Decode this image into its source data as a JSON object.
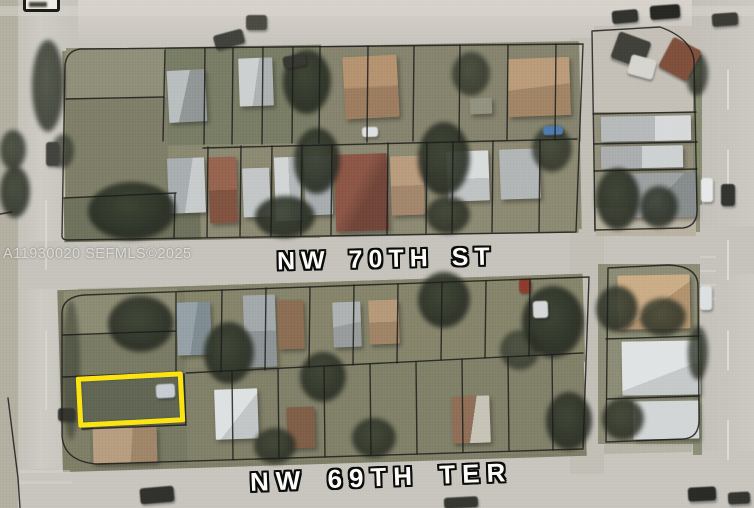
{
  "map": {
    "type": "aerial-parcel-map",
    "streets": {
      "horizontal_mid": "NW 70TH ST",
      "horizontal_bottom": "NW 69TH TER"
    },
    "watermark": "A11930020 SEFMLS©2025",
    "colors": {
      "highlight": "#FFE50A",
      "parcel_line": "#141414",
      "road": "#C9C6C0",
      "label_text": "#FFFFFF",
      "label_outline": "#000000"
    },
    "features": {
      "patches": [
        {
          "x": 0,
          "y": 0,
          "w": 18,
          "h": 508,
          "c": "#b3afa2"
        },
        {
          "x": 64,
          "y": 46,
          "w": 516,
          "h": 188,
          "c": "#87866f",
          "r": -1.1
        },
        {
          "x": 66,
          "y": 48,
          "w": 100,
          "h": 52,
          "c": "#8e8d76"
        },
        {
          "x": 66,
          "y": 98,
          "w": 102,
          "h": 100,
          "c": "#7c7c66"
        },
        {
          "x": 166,
          "y": 46,
          "w": 156,
          "h": 98,
          "c": "#757a62",
          "r": -1
        },
        {
          "x": 320,
          "y": 44,
          "w": 260,
          "h": 100,
          "c": "#83816b",
          "r": -1
        },
        {
          "x": 64,
          "y": 196,
          "w": 256,
          "h": 44,
          "c": "#6b6e58",
          "r": -1
        },
        {
          "x": 200,
          "y": 146,
          "w": 378,
          "h": 90,
          "c": "#8a8770",
          "r": -1
        },
        {
          "x": 594,
          "y": 26,
          "w": 104,
          "h": 88,
          "c": "#c4c0b8"
        },
        {
          "x": 594,
          "y": 112,
          "w": 106,
          "h": 120,
          "c": "#8f8d78"
        },
        {
          "x": 596,
          "y": 208,
          "w": 100,
          "h": 28,
          "c": "#b9b2a2"
        },
        {
          "x": 60,
          "y": 282,
          "w": 524,
          "h": 182,
          "c": "#7c7b64",
          "r": -1.8
        },
        {
          "x": 64,
          "y": 290,
          "w": 114,
          "h": 44,
          "c": "#8a8971",
          "r": -1.5
        },
        {
          "x": 64,
          "y": 334,
          "w": 120,
          "h": 44,
          "c": "#777861",
          "r": -1.5
        },
        {
          "x": 80,
          "y": 376,
          "w": 108,
          "h": 52,
          "c": "#5c6350",
          "r": -3
        },
        {
          "x": 90,
          "y": 428,
          "w": 100,
          "h": 38,
          "c": "#74755f",
          "r": -1.5
        },
        {
          "x": 186,
          "y": 280,
          "w": 398,
          "h": 88,
          "c": "#838269",
          "r": -1.8
        },
        {
          "x": 186,
          "y": 362,
          "w": 398,
          "h": 96,
          "c": "#7e7d66",
          "r": -1.8
        },
        {
          "x": 598,
          "y": 264,
          "w": 102,
          "h": 180,
          "c": "#8b8a73"
        },
        {
          "x": 693,
          "y": 55,
          "w": 9,
          "h": 150,
          "c": "#7f8468",
          "o": 0.9
        },
        {
          "x": 693,
          "y": 335,
          "w": 9,
          "h": 120,
          "c": "#7f8468",
          "o": 0.85
        },
        {
          "x": 0,
          "y": 6,
          "w": 754,
          "h": 10,
          "c": "#dcd7d1",
          "o": 0.5
        },
        {
          "x": 45,
          "y": 60,
          "w": 2,
          "h": 60,
          "c": "#e8e5df",
          "o": 0.4
        },
        {
          "x": 45,
          "y": 200,
          "w": 2,
          "h": 70,
          "c": "#e8e5df",
          "o": 0.5
        },
        {
          "x": 45,
          "y": 330,
          "w": 2,
          "h": 80,
          "c": "#e8e5df",
          "o": 0.45
        },
        {
          "x": 727,
          "y": 70,
          "w": 2,
          "h": 40,
          "c": "#eeece6",
          "o": 0.6
        },
        {
          "x": 727,
          "y": 150,
          "w": 2,
          "h": 40,
          "c": "#eeece6",
          "o": 0.6
        },
        {
          "x": 727,
          "y": 240,
          "w": 2,
          "h": 40,
          "c": "#eeece6",
          "o": 0.6
        },
        {
          "x": 727,
          "y": 330,
          "w": 2,
          "h": 40,
          "c": "#eeece6",
          "o": 0.6
        },
        {
          "x": 727,
          "y": 420,
          "w": 2,
          "h": 40,
          "c": "#eeece6",
          "o": 0.6
        },
        {
          "x": 700,
          "y": 256,
          "w": 16,
          "h": 2,
          "c": "#dddbd5",
          "o": 0.5
        },
        {
          "x": 700,
          "y": 270,
          "w": 16,
          "h": 2,
          "c": "#dddbd5",
          "o": 0.5
        },
        {
          "x": 700,
          "y": 284,
          "w": 16,
          "h": 2,
          "c": "#dddbd5",
          "o": 0.5
        },
        {
          "x": 700,
          "y": 298,
          "w": 16,
          "h": 2,
          "c": "#dddbd5",
          "o": 0.5
        },
        {
          "x": 20,
          "y": 470,
          "w": 50,
          "h": 3,
          "c": "#d8d5cf",
          "o": 0.5
        },
        {
          "x": 20,
          "y": 481,
          "w": 52,
          "h": 3,
          "c": "#d8d5cf",
          "o": 0.45
        }
      ],
      "houses": [
        {
          "x": 168,
          "y": 70,
          "w": 38,
          "h": 52,
          "c": "linear-gradient(105deg,#b9bec0 45%,#8f9496 45%)",
          "r": -3
        },
        {
          "x": 239,
          "y": 58,
          "w": 34,
          "h": 48,
          "c": "linear-gradient(100deg,#cdd1d3 50%,#aeb2b4 50%)",
          "r": -2
        },
        {
          "x": 344,
          "y": 56,
          "w": 54,
          "h": 62,
          "c": "linear-gradient(180deg,#b5916e 48%,#9a7a5c 52%)",
          "r": -3
        },
        {
          "x": 508,
          "y": 58,
          "w": 62,
          "h": 58,
          "c": "linear-gradient(175deg,#bb9a78 50%,#a08263 50%)",
          "r": -2
        },
        {
          "x": 470,
          "y": 98,
          "w": 22,
          "h": 16,
          "c": "#90907f",
          "r": -2
        },
        {
          "x": 168,
          "y": 158,
          "w": 37,
          "h": 55,
          "c": "linear-gradient(100deg,#a8aeb0 55%,#c8cccd 55%)",
          "r": -2
        },
        {
          "x": 209,
          "y": 157,
          "w": 28,
          "h": 66,
          "c": "linear-gradient(180deg,#95604a 50%,#7e4e3c 50%)",
          "r": -2
        },
        {
          "x": 243,
          "y": 168,
          "w": 27,
          "h": 49,
          "c": "#c3c7c9",
          "r": -2
        },
        {
          "x": 275,
          "y": 157,
          "w": 26,
          "h": 64,
          "c": "linear-gradient(90deg,#d2d6d8 55%,#b4b8ba 55%)",
          "r": -2
        },
        {
          "x": 305,
          "y": 156,
          "w": 27,
          "h": 59,
          "c": "#a6acae",
          "r": -2
        },
        {
          "x": 335,
          "y": 154,
          "w": 53,
          "h": 77,
          "c": "linear-gradient(120deg,#8a5242 40%,#6e4034 60%)",
          "r": -2
        },
        {
          "x": 391,
          "y": 156,
          "w": 33,
          "h": 59,
          "c": "linear-gradient(180deg,#b99a7c 50%,#a2846a 50%)",
          "r": -2
        },
        {
          "x": 447,
          "y": 151,
          "w": 42,
          "h": 50,
          "c": "linear-gradient(180deg,#dadee0 55%,#bfc3c5 45%)",
          "r": -2
        },
        {
          "x": 500,
          "y": 149,
          "w": 40,
          "h": 50,
          "c": "#b2b6b8",
          "r": -2
        },
        {
          "x": 601,
          "y": 116,
          "w": 90,
          "h": 25,
          "c": "linear-gradient(90deg,#b6babc 60%,#d8dbdd 60%)",
          "r": -1
        },
        {
          "x": 601,
          "y": 146,
          "w": 82,
          "h": 22,
          "c": "linear-gradient(90deg,#a9adaf 50%,#cfd2d4 50%)",
          "r": -1
        },
        {
          "x": 630,
          "y": 173,
          "w": 66,
          "h": 44,
          "c": "linear-gradient(135deg,#9a9fa1 50%,#84898b 50%)",
          "r": -1
        },
        {
          "x": 177,
          "y": 302,
          "w": 34,
          "h": 53,
          "c": "linear-gradient(100deg,#93a0a6 50%,#7c8a90 50%)",
          "r": -2
        },
        {
          "x": 244,
          "y": 295,
          "w": 32,
          "h": 72,
          "c": "linear-gradient(180deg,#a2a8aa 50%,#8c9294 50%)",
          "r": -2
        },
        {
          "x": 278,
          "y": 300,
          "w": 26,
          "h": 49,
          "c": "#8a6a50",
          "r": -2
        },
        {
          "x": 333,
          "y": 302,
          "w": 28,
          "h": 45,
          "c": "linear-gradient(170deg,#aeb2b4 50%,#969a9c 50%)",
          "r": -2
        },
        {
          "x": 369,
          "y": 300,
          "w": 30,
          "h": 44,
          "c": "linear-gradient(180deg,#b59878 50%,#9e8162 50%)",
          "r": -2
        },
        {
          "x": 93,
          "y": 427,
          "w": 64,
          "h": 36,
          "c": "linear-gradient(95deg,#b89c7e 60%,#9f8366 40%)",
          "r": -1.5
        },
        {
          "x": 215,
          "y": 389,
          "w": 43,
          "h": 50,
          "c": "linear-gradient(130deg,#e0e3e5 55%,#c3c7c9 45%)",
          "r": -2
        },
        {
          "x": 287,
          "y": 407,
          "w": 28,
          "h": 41,
          "c": "#7d5a44",
          "r": -2
        },
        {
          "x": 452,
          "y": 396,
          "w": 38,
          "h": 47,
          "c": "linear-gradient(100deg,#8d6b54 55%,#c9c3b8 45%)",
          "r": -2
        },
        {
          "x": 618,
          "y": 275,
          "w": 72,
          "h": 54,
          "c": "linear-gradient(145deg,#cbac85 55%,#b2916c 45%)",
          "r": -1
        },
        {
          "x": 622,
          "y": 341,
          "w": 78,
          "h": 54,
          "c": "linear-gradient(160deg,#e2e5e7 60%,#c6cacc 40%)",
          "r": -1
        },
        {
          "x": 633,
          "y": 401,
          "w": 66,
          "h": 38,
          "c": "#d4d7d9",
          "r": -1
        }
      ],
      "trees": [
        {
          "x": 32,
          "y": 40,
          "w": 32,
          "h": 92,
          "o": 0.8
        },
        {
          "x": 0,
          "y": 130,
          "w": 26,
          "h": 40,
          "o": 0.8
        },
        {
          "x": 0,
          "y": 166,
          "w": 30,
          "h": 52,
          "o": 0.85
        },
        {
          "x": 52,
          "y": 134,
          "w": 22,
          "h": 34,
          "o": 0.7
        },
        {
          "x": 283,
          "y": 50,
          "w": 48,
          "h": 64,
          "o": 0.9
        },
        {
          "x": 294,
          "y": 128,
          "w": 46,
          "h": 66,
          "o": 0.9
        },
        {
          "x": 255,
          "y": 196,
          "w": 60,
          "h": 42,
          "o": 0.9
        },
        {
          "x": 88,
          "y": 182,
          "w": 88,
          "h": 58,
          "o": 0.92
        },
        {
          "x": 418,
          "y": 122,
          "w": 52,
          "h": 74,
          "o": 0.9
        },
        {
          "x": 452,
          "y": 52,
          "w": 38,
          "h": 44,
          "o": 0.75
        },
        {
          "x": 532,
          "y": 126,
          "w": 40,
          "h": 46,
          "o": 0.8
        },
        {
          "x": 426,
          "y": 196,
          "w": 44,
          "h": 38,
          "o": 0.85
        },
        {
          "x": 596,
          "y": 168,
          "w": 44,
          "h": 62,
          "o": 0.9
        },
        {
          "x": 640,
          "y": 186,
          "w": 38,
          "h": 42,
          "o": 0.85
        },
        {
          "x": 686,
          "y": 52,
          "w": 22,
          "h": 44,
          "o": 0.8
        },
        {
          "x": 688,
          "y": 326,
          "w": 20,
          "h": 54,
          "o": 0.8
        },
        {
          "x": 108,
          "y": 296,
          "w": 66,
          "h": 56,
          "o": 0.9
        },
        {
          "x": 204,
          "y": 322,
          "w": 50,
          "h": 62,
          "o": 0.9
        },
        {
          "x": 300,
          "y": 352,
          "w": 46,
          "h": 50,
          "o": 0.88
        },
        {
          "x": 418,
          "y": 272,
          "w": 52,
          "h": 56,
          "o": 0.9
        },
        {
          "x": 522,
          "y": 286,
          "w": 62,
          "h": 72,
          "o": 0.92
        },
        {
          "x": 546,
          "y": 392,
          "w": 46,
          "h": 58,
          "o": 0.9
        },
        {
          "x": 254,
          "y": 428,
          "w": 42,
          "h": 36,
          "o": 0.85
        },
        {
          "x": 352,
          "y": 418,
          "w": 44,
          "h": 40,
          "o": 0.85
        },
        {
          "x": 596,
          "y": 286,
          "w": 42,
          "h": 46,
          "o": 0.85
        },
        {
          "x": 640,
          "y": 298,
          "w": 46,
          "h": 38,
          "o": 0.8
        },
        {
          "x": 602,
          "y": 398,
          "w": 42,
          "h": 42,
          "o": 0.85
        },
        {
          "x": 500,
          "y": 330,
          "w": 40,
          "h": 40,
          "o": 0.7
        },
        {
          "x": 62,
          "y": 300,
          "w": 18,
          "h": 140,
          "o": 0.5
        }
      ],
      "cars": [
        {
          "x": 214,
          "y": 32,
          "w": 30,
          "h": 15,
          "c": "#3b3b37",
          "r": -15
        },
        {
          "x": 246,
          "y": 15,
          "w": 21,
          "h": 15,
          "c": "#45453f"
        },
        {
          "x": 283,
          "y": 55,
          "w": 23,
          "h": 12,
          "c": "#32322e",
          "r": -10
        },
        {
          "x": 612,
          "y": 10,
          "w": 26,
          "h": 13,
          "c": "#2b2b28",
          "r": -5
        },
        {
          "x": 650,
          "y": 5,
          "w": 30,
          "h": 14,
          "c": "#1f1f1d",
          "r": -4
        },
        {
          "x": 712,
          "y": 13,
          "w": 26,
          "h": 13,
          "c": "#353531",
          "r": -4
        },
        {
          "x": 46,
          "y": 142,
          "w": 13,
          "h": 24,
          "c": "#3d3d39"
        },
        {
          "x": 58,
          "y": 408,
          "w": 17,
          "h": 13,
          "c": "#2e2e2a"
        },
        {
          "x": 701,
          "y": 178,
          "w": 12,
          "h": 24,
          "c": "#e8eaec"
        },
        {
          "x": 721,
          "y": 184,
          "w": 14,
          "h": 22,
          "c": "#2c2c29"
        },
        {
          "x": 700,
          "y": 286,
          "w": 12,
          "h": 24,
          "c": "#dfe2e4"
        },
        {
          "x": 140,
          "y": 487,
          "w": 34,
          "h": 16,
          "c": "#2a2a27",
          "r": -5
        },
        {
          "x": 444,
          "y": 497,
          "w": 34,
          "h": 11,
          "c": "#30302c",
          "r": -3
        },
        {
          "x": 688,
          "y": 487,
          "w": 28,
          "h": 14,
          "c": "#222220",
          "r": -3
        },
        {
          "x": 728,
          "y": 492,
          "w": 22,
          "h": 12,
          "c": "#2d2d2a",
          "r": -3
        },
        {
          "x": 156,
          "y": 384,
          "w": 19,
          "h": 14,
          "c": "#c8ced4",
          "r": -3
        },
        {
          "x": 543,
          "y": 126,
          "w": 20,
          "h": 9,
          "c": "#4a78ae",
          "r": -2
        },
        {
          "x": 362,
          "y": 127,
          "w": 16,
          "h": 10,
          "c": "#dfe1e3",
          "r": -2
        },
        {
          "x": 519,
          "y": 279,
          "w": 12,
          "h": 14,
          "c": "#8c3428",
          "r": -2
        },
        {
          "x": 533,
          "y": 301,
          "w": 15,
          "h": 17,
          "c": "#d6d9db",
          "r": -2
        },
        {
          "x": 614,
          "y": 36,
          "w": 34,
          "h": 28,
          "c": "#3a3a35",
          "r": 20
        },
        {
          "x": 664,
          "y": 42,
          "w": 32,
          "h": 34,
          "c": "#7c4a36",
          "r": 28
        },
        {
          "x": 629,
          "y": 57,
          "w": 26,
          "h": 20,
          "c": "#d8d6d2",
          "r": 15
        }
      ],
      "parcel_paths": [
        "M583,44 L80,49 Q66,51 65,66 L62,236 Q62,240 68,240 L576,232 Z",
        "M165,50 L163,141",
        "M66,99 L164,97",
        "M64,198 L176,193",
        "M205,48 L204,144",
        "M233,48 L232,144",
        "M263,47 L262,144",
        "M293,47 L292,143",
        "M320,47 L319,143",
        "M368,46 L367,142",
        "M414,46 L413,141",
        "M460,45 L459,141",
        "M508,45 L507,140",
        "M556,44 L555,140",
        "M203,148 L577,139",
        "M175,194 L174,238",
        "M208,147 L207,237",
        "M241,146 L240,236",
        "M272,146 L271,236",
        "M302,145 L301,235",
        "M332,145 L331,235",
        "M388,143 L387,234",
        "M427,143 L426,233",
        "M453,142 L452,233",
        "M493,141 L492,232",
        "M540,140 L539,232",
        "M592,31 L660,27 Q691,38 694,60 L697,208 Q698,226 683,228 L595,230 Z",
        "M593,114 L696,112",
        "M594,144 L697,142",
        "M594,171 L697,169",
        "M84,295 L589,277 L583,449 L96,464 Q64,461 62,436 L62,312 Q63,297 84,295 Z",
        "M63,335 L176,331",
        "M176,293 L176,374",
        "M63,377 L182,372",
        "M82,429 L186,425",
        "M184,374 L186,425",
        "M186,373 L583,353",
        "M222,290 L221,372",
        "M266,288 L265,370",
        "M310,287 L309,367",
        "M354,285 L353,365",
        "M398,284 L397,363",
        "M442,282 L441,360",
        "M486,281 L485,358",
        "M530,279 L529,356",
        "M232,372 L233,460",
        "M278,369 L279,458",
        "M324,367 L325,457",
        "M370,364 L371,455",
        "M416,362 L417,454",
        "M462,359 L463,452",
        "M508,357 L509,451",
        "M552,355 L553,450",
        "M608,268 L668,265 Q698,266 698,286 L699,420 Q699,438 683,439 L606,442 Z",
        "M606,339 L699,336",
        "M607,399 L699,396",
        "M8,398 L18,478 L20,508",
        "M0,214 L12,212"
      ]
    }
  }
}
